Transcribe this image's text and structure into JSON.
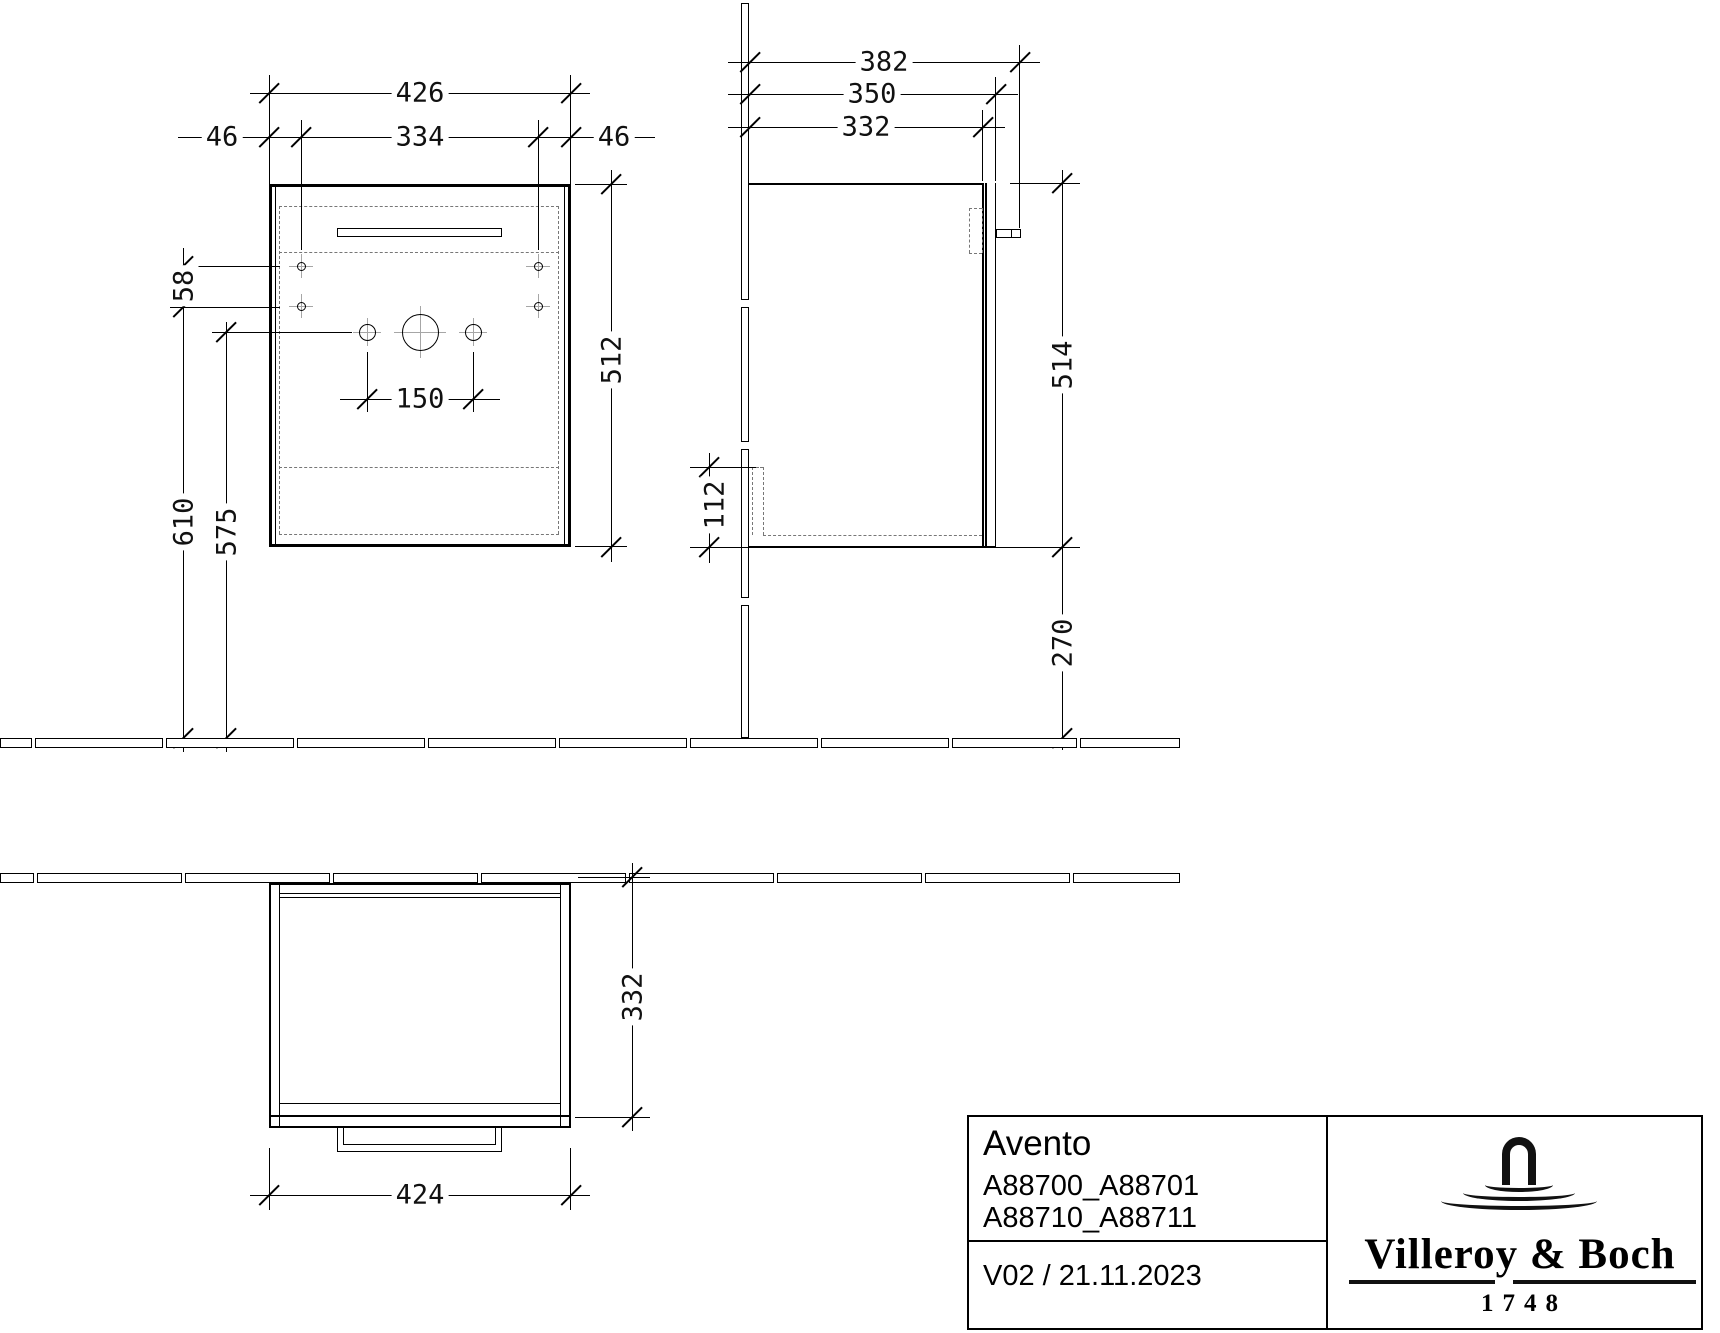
{
  "drawing": {
    "front_view": {
      "dims": {
        "total_width": "426",
        "left_hole_offset": "46",
        "hole_span": "334",
        "right_hole_offset": "46",
        "height": "512",
        "hole_row_spacing": "58",
        "floor_to_lower_holes": "610",
        "floor_to_faucet_holes": "575",
        "faucet_hole_spacing": "150"
      }
    },
    "side_view": {
      "dims": {
        "depth_with_handle": "382",
        "depth_with_door": "350",
        "carcass_depth": "332",
        "height": "514",
        "bottom_recess_height": "112",
        "floor_clearance": "270"
      }
    },
    "top_view": {
      "dims": {
        "depth": "332",
        "width": "424"
      }
    }
  },
  "title_block": {
    "product_line": "Avento",
    "article_numbers_line1": "A88700_A88701",
    "article_numbers_line2": "A88710_A88711",
    "revision_date": "V02 / 21.11.2023",
    "brand_name": "Villeroy & Boch",
    "brand_founding_year": "1748"
  },
  "colors": {
    "line": "#000000",
    "dashed": "#777777",
    "centerline": "#a6a6a6",
    "background": "#ffffff"
  }
}
